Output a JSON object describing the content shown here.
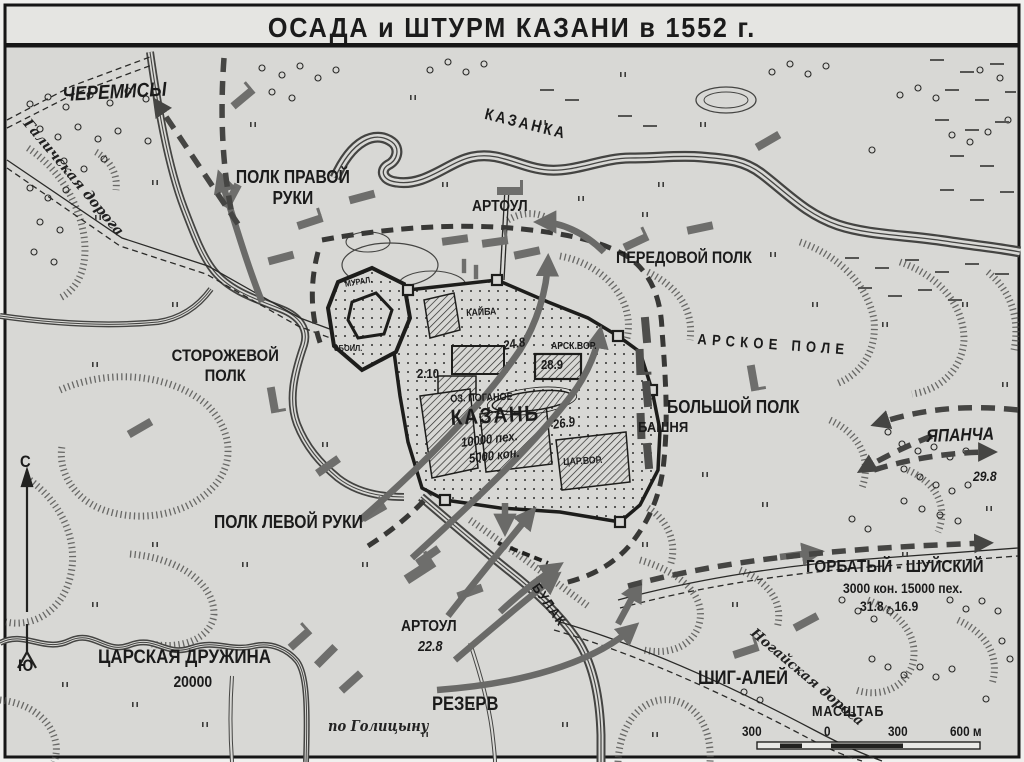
{
  "title": "ОСАДА и ШТУРМ КАЗАНИ в 1552 г.",
  "colors": {
    "paper": "#d8d8d5",
    "ink": "#1b1b1b",
    "troop_gray": "#6e6e6c"
  },
  "compass": {
    "north": "С",
    "south": "Ю"
  },
  "regions": {
    "cheremisy": "ЧЕРЕМИСЫ",
    "arskoe_pole": "АРСКОЕ ПОЛЕ"
  },
  "rivers": {
    "kazanka": "КАЗАНКА",
    "bulak": "БУЛАК"
  },
  "roads": {
    "galichskaya": "Галичская дорога",
    "nogayskaya": "Ногайская дорога"
  },
  "city": {
    "name": "КАЗАНЬ",
    "lake": "ОЗ. ПОГАНОЕ",
    "infantry": "10000 пех.",
    "cavalry": "5000 кон.",
    "tower": "БАШНЯ",
    "gates": {
      "muraleevy": "МУРАЛ.",
      "zboylivye": "ЗБОИЛ.",
      "kaybatskie": "КАЙБА",
      "arskie": "АРСК.ВОР.",
      "tsarevy": "ЦАР.ВОР."
    },
    "dates": {
      "kaybat": "24.8",
      "arsk": "28.9",
      "kremlin": "2.10",
      "tsarev": "26.9"
    }
  },
  "forces": {
    "polk_pravoy_ruki": "ПОЛК ПРАВОЙ РУКИ",
    "artoul_north": "АРТОУЛ",
    "peredovoy_polk": "ПЕРЕДОВОЙ ПОЛК",
    "bolshoy_polk": "БОЛЬШОЙ ПОЛК",
    "storozhevoy_polk": "СТОРОЖЕВОЙ ПОЛК",
    "polk_levoy_ruki": "ПОЛК ЛЕВОЙ РУКИ",
    "rezerv": "РЕЗЕРВ",
    "shig_aley": "ШИГ-АЛЕЙ",
    "tsarskaya_druzhina": {
      "name": "ЦАРСКАЯ ДРУЖИНА",
      "strength": "20000"
    },
    "artoul_south": {
      "name": "АРТОУЛ",
      "date": "22.8"
    },
    "yapancha": {
      "name": "ЯПАНЧА",
      "date": "29.8"
    },
    "gorbaty_shuysky": {
      "name": "ГОРБАТЫЙ - ШУЙСКИЙ",
      "strength": "3000 кон. 15000 пех.",
      "dates": "31.8 - 16.9"
    }
  },
  "scale": {
    "label": "МАСШТАБ",
    "ticks": [
      "300",
      "0",
      "300",
      "600 м"
    ]
  },
  "source": "по Голицыну"
}
